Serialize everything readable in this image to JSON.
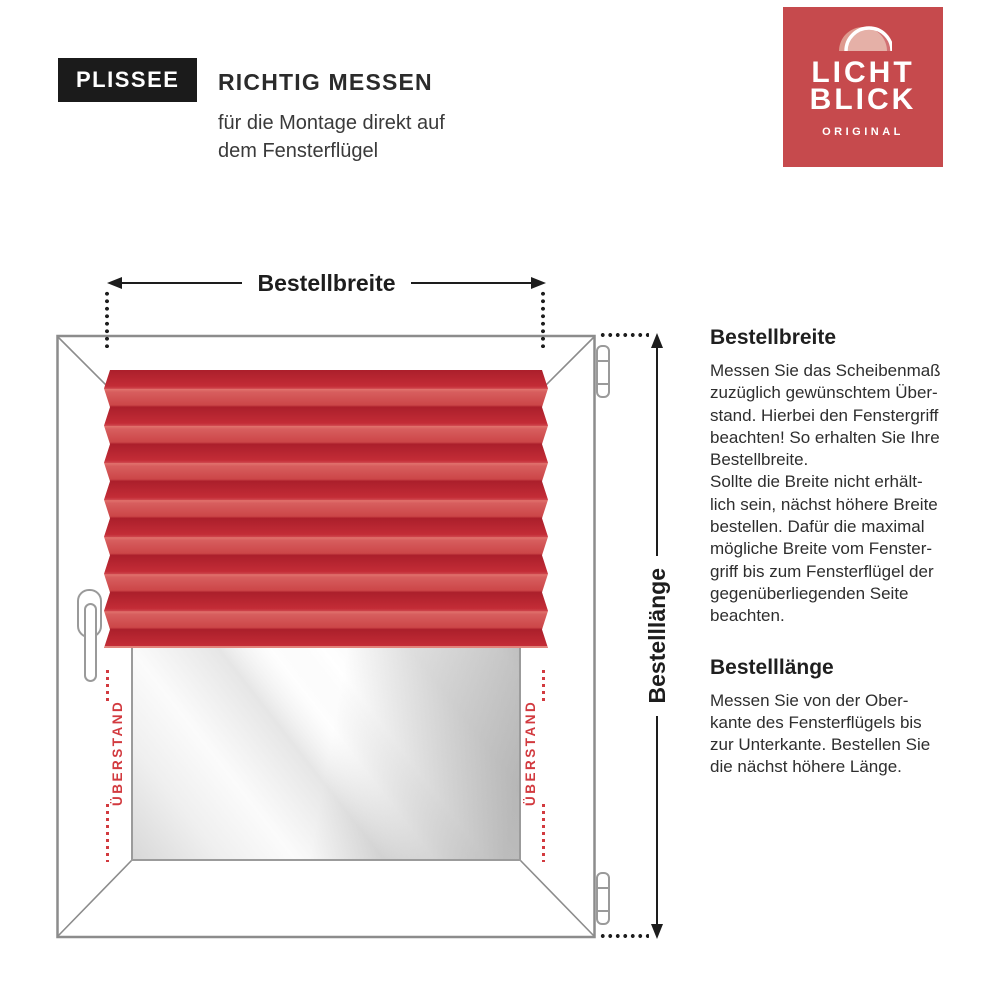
{
  "header": {
    "badge": "PLISSEE",
    "title": "RICHTIG MESSEN",
    "subtitle": "für die Montage direkt auf\ndem Fensterflügel"
  },
  "logo": {
    "line1": "LICHT",
    "line2": "BLICK",
    "tagline": "ORIGINAL"
  },
  "measure": {
    "width_label": "Bestellbreite",
    "length_label": "Bestelllänge",
    "overhang_left": "ÜBERSTAND",
    "overhang_right": "ÜBERSTAND"
  },
  "info": {
    "sections": [
      {
        "heading": "Bestellbreite",
        "body": "Messen Sie das Scheibenmaß\nzuzüglich gewünschtem Über-\nstand. Hierbei den Fenstergriff\nbeachten! So erhalten Sie Ihre\nBestellbreite.\nSollte die Breite nicht erhält-\nlich sein, nächst höhere Breite\nbestellen. Dafür die maximal\nmögliche Breite vom Fenster-\ngriff bis zum Fensterflügel der\ngegenüberliegenden Seite\nbeachten."
      },
      {
        "heading": "Bestelllänge",
        "body": "Messen Sie von der Ober-\nkante des Fensterflügels bis\nzur Unterkante. Bestellen Sie\ndie nächst höhere Länge."
      }
    ]
  },
  "colors": {
    "accent_red": "#d23a3f",
    "logo_red": "#c64a4d",
    "blind_dark": "#ab1f2b",
    "blind_light": "#cc4648",
    "frame_gray": "#8c8c8c",
    "text_dark": "#2b2b2b"
  }
}
